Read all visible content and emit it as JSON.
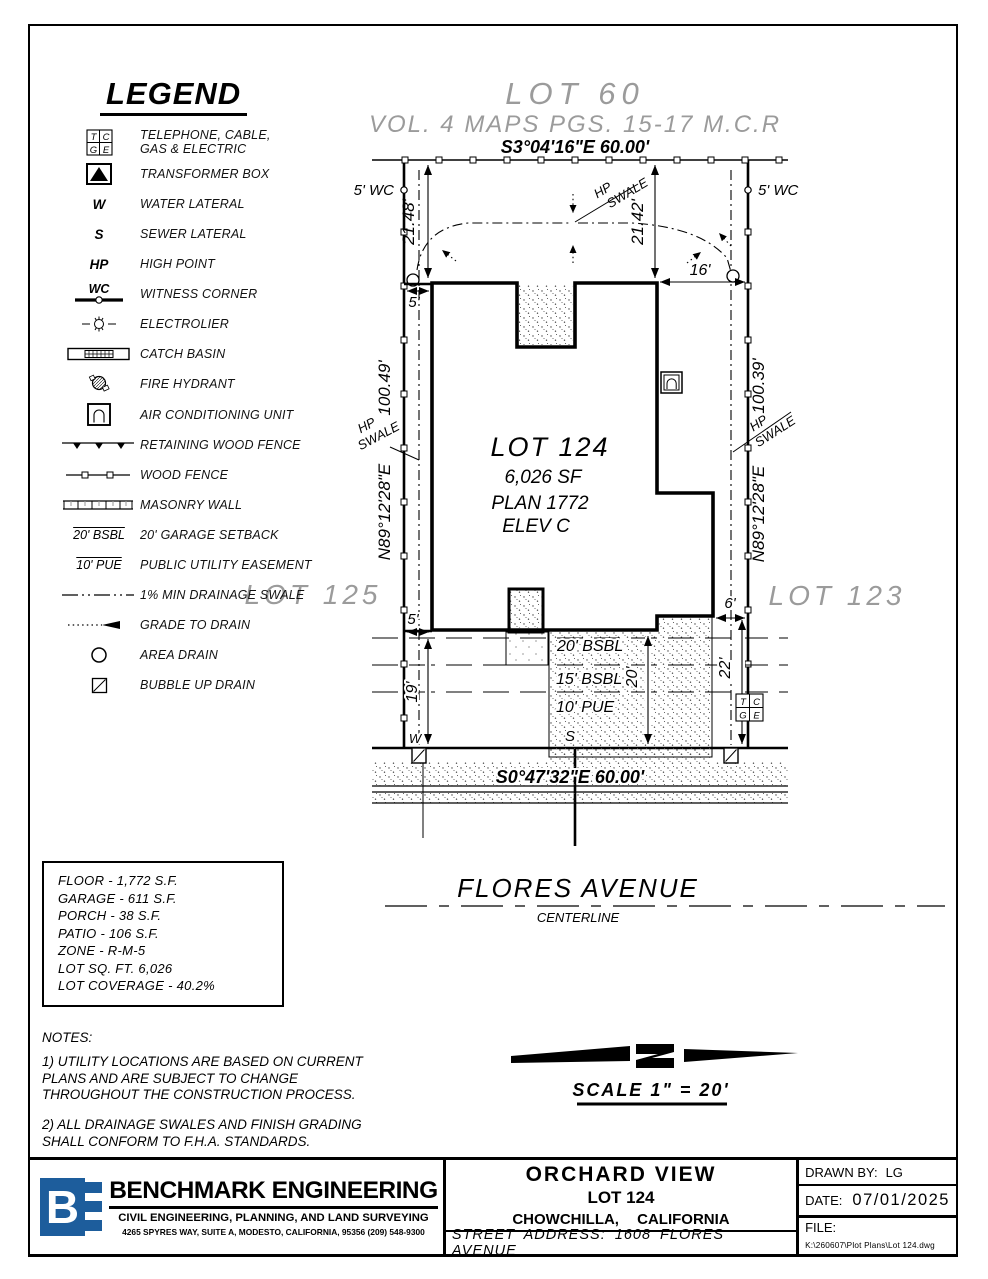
{
  "colors": {
    "brand_blue": "#1d5d9c",
    "context_gray": "#9b9b9b",
    "line": "#000000"
  },
  "legend": {
    "title": "LEGEND",
    "tcge": {
      "t": "T",
      "c": "C",
      "g": "G",
      "e": "E"
    },
    "sym": {
      "w": "W",
      "s": "S",
      "hp": "HP",
      "wc": "WC",
      "bsbl": "20' BSBL",
      "pue": "10' PUE"
    },
    "items": [
      {
        "label": "TELEPHONE, CABLE,\nGAS & ELECTRIC"
      },
      {
        "label": "TRANSFORMER BOX"
      },
      {
        "label": "WATER LATERAL"
      },
      {
        "label": "SEWER LATERAL"
      },
      {
        "label": "HIGH POINT"
      },
      {
        "label": "WITNESS CORNER"
      },
      {
        "label": "ELECTROLIER"
      },
      {
        "label": "CATCH BASIN"
      },
      {
        "label": "FIRE HYDRANT"
      },
      {
        "label": "AIR CONDITIONING UNIT"
      },
      {
        "label": "RETAINING WOOD FENCE"
      },
      {
        "label": "WOOD FENCE"
      },
      {
        "label": "MASONRY WALL"
      },
      {
        "label": "20' GARAGE SETBACK"
      },
      {
        "label": "PUBLIC UTILITY EASEMENT"
      },
      {
        "label": "1% MIN DRAINAGE SWALE"
      },
      {
        "label": "GRADE TO DRAIN"
      },
      {
        "label": "AREA DRAIN"
      },
      {
        "label": "BUBBLE UP DRAIN"
      }
    ]
  },
  "context": {
    "lot_top": "LOT 60",
    "vol": "VOL. 4 MAPS PGS. 15-17 M.C.R",
    "lot_left": "LOT 125",
    "lot_right": "LOT 123",
    "street": "FLORES AVENUE",
    "centerline": "CENTERLINE"
  },
  "bearings": {
    "top": "S3°04'16\"E 60.00'",
    "bottom": "S0°47'32\"E 60.00'",
    "side_left": "N89°12'28\"E",
    "side_right": "N89°12'28\"E",
    "left_len": "100.49'",
    "right_len": "100.39'"
  },
  "dims": {
    "d21_48": "21.48'",
    "d21_42": "21.42'",
    "d16": "16'",
    "d5_top": "5'",
    "d5_bot": "5'",
    "d6": "6'",
    "d19": "19'",
    "d20": "20'",
    "d22": "22'",
    "wc_left": "5' WC",
    "wc_right": "5' WC"
  },
  "house": {
    "lot": "LOT 124",
    "sf": "6,026 SF",
    "plan": "PLAN 1772",
    "elev": "ELEV C"
  },
  "setbacks": {
    "bsbl20": "20' BSBL",
    "bsbl15": "15' BSBL",
    "pue10": "10' PUE"
  },
  "laterals": {
    "w": "W",
    "s": "S"
  },
  "swale": {
    "hp": "HP",
    "label": "SWALE"
  },
  "scale": {
    "label": "SCALE 1\" = 20'"
  },
  "stats": {
    "lines": [
      "FLOOR - 1,772 S.F.",
      "GARAGE - 611 S.F.",
      "PORCH - 38 S.F.",
      "PATIO - 106 S.F.",
      "ZONE - R-M-5",
      "LOT SQ. FT. 6,026",
      "LOT COVERAGE - 40.2%"
    ]
  },
  "notes": {
    "heading": "NOTES:",
    "n1": "1) UTILITY LOCATIONS ARE BASED ON CURRENT PLANS AND ARE SUBJECT TO CHANGE THROUGHOUT THE CONSTRUCTION PROCESS.",
    "n2": "2) ALL DRAINAGE SWALES AND FINISH GRADING SHALL CONFORM TO F.H.A. STANDARDS."
  },
  "titleblock": {
    "logo_b": "B",
    "company": "BENCHMARK ENGINEERING",
    "tagline": "CIVIL ENGINEERING, PLANNING, AND LAND SURVEYING",
    "address": "4265 SPYRES WAY, SUITE A, MODESTO, CALIFORNIA, 95356    (209) 548-9300",
    "project": "ORCHARD VIEW",
    "lot": "LOT 124",
    "city": "CHOWCHILLA, CALIFORNIA",
    "street_address": "STREET ADDRESS: 1608 FLORES AVENUE",
    "drawn_label": "DRAWN BY:",
    "drawn_value": "LG",
    "date_label": "DATE:",
    "date_value": "07/01/2025",
    "file_label": "FILE:",
    "file_path": "K:\\260607\\Plot Plans\\Lot 124.dwg"
  }
}
